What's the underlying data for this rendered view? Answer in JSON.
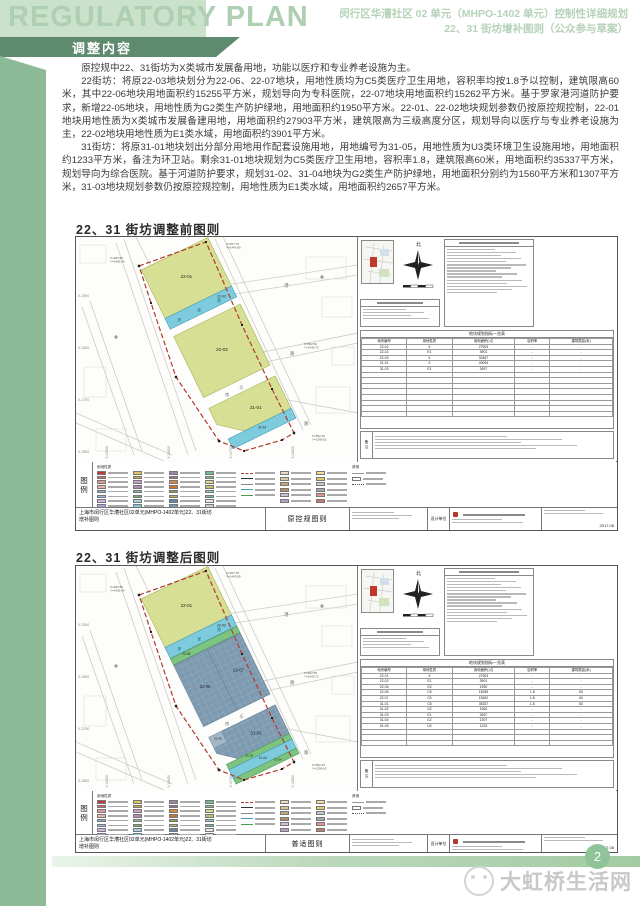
{
  "header": {
    "title": "REGULATORY PLAN",
    "banner": "调整内容",
    "line1": "闵行区华漕社区 02 单元（MHPO-1402 单元）控制性详细规划",
    "line2": "22、31 街坊增补图则（公众参与草案）"
  },
  "body": {
    "p1": "原控规中22、31街坊为X类城市发展备用地，功能以医疗和专业养老设施为主。",
    "p2": "22街坊：将原22-03地块划分为22-06、22-07地块，用地性质均为C5类医疗卫生用地，容积率均按1.8予以控制，建筑限高60米，其中22-06地块用地面积约15255平方米，规划导向为专科医院，22-07地块用地面积约15262平方米。基于罗家港河道防护要求，新增22-05地块，用地性质为G2类生产防护绿地，用地面积约1950平方米。22-01、22-02地块规划参数仍按原控规控制，22-01地块用地性质为X类城市发展备建用地，用地面积约27903平方米，建筑限高为三级高度分区，规划导向以医疗与专业养老设施为主，22-02地块用地性质为E1类水域，用地面积约3901平方米。",
    "p3": "31街坊：将原31-01地块划出分部分用地用作配套设施用地，用地编号为31-05，用地性质为U3类环境卫生设施用地，用地面积约1233平方米，备注为环卫站。剩余31-01地块规划为C5类医疗卫生用地，容积率1.8，建筑限高60米，用地面积约35337平方米，规划导向为综合医院。基于河道防护要求，规划31-02、31-04地块为G2类生产防护绿地，用地面积分别约为1560平方米和1307平方米，31-03地块规划参数仍按原控规控制，用地性质为E1类水域，用地面积约2657平方米。"
  },
  "sections": {
    "before_title": "22、31 街坊调整前图则",
    "after_title": "22、31 街坊调整后图则"
  },
  "colors": {
    "boundary_red": "#b03a2e",
    "parcel_yellow": "#d6df93",
    "parcel_yellow_stroke": "#a9b25e",
    "water_blue": "#7ecbde",
    "water_stroke": "#3f9cb8",
    "medical_blue": "#7d9ab0",
    "medical_stroke": "#5f7e96",
    "green_g2": "#7cc47f",
    "green_g2_stroke": "#4a9a50",
    "u3_fill": "#a3b7c6",
    "u3_stroke": "#7f96a8",
    "map_line": "#cccbc5",
    "map_rect": "#dddcd6"
  },
  "map_common": {
    "grid_labels_left": [
      "X-2500",
      "X-2600",
      "X-2700",
      "X-2800"
    ],
    "grid_labels_bottom": [
      "Y-14500",
      "Y-14600",
      "Y-14700",
      "Y-14800"
    ],
    "river_chars": [
      "罗",
      "家",
      "港"
    ],
    "road_gap_chars": [
      "南",
      "乐"
    ],
    "roadside_chars": [
      [
        "港",
        208,
        50
      ],
      [
        "路",
        214,
        118
      ],
      [
        "路",
        228,
        188
      ]
    ],
    "corner_notes": [
      {
        "l1": "X=263.56",
        "l2": "Y=1462.64",
        "x": 34,
        "y": 22
      },
      {
        "l1": "X=257.78",
        "l2": "Y=1443.89",
        "x": 150,
        "y": 8
      },
      {
        "l1": "X=502.59",
        "l2": "Y=1445.72",
        "x": 228,
        "y": 108
      },
      {
        "l1": "X=592.45",
        "l2": "Y=1396.62",
        "x": 236,
        "y": 200
      }
    ],
    "boundary": "63,29 130,5 166,88 196,152 218,196 206,203 168,214 143,204 100,140 75,66",
    "road_lines": [
      [
        40,
        6,
        112,
        218
      ],
      [
        48,
        2,
        120,
        214
      ],
      [
        6,
        70,
        58,
        218
      ],
      [
        14,
        64,
        66,
        214
      ],
      [
        139,
        2,
        227,
        193
      ],
      [
        147,
        0,
        235,
        188
      ],
      [
        150,
        48,
        282,
        28
      ],
      [
        152,
        58,
        282,
        38
      ],
      [
        172,
        118,
        282,
        96
      ],
      [
        175,
        128,
        282,
        106
      ],
      [
        0,
        176,
        96,
        218
      ],
      [
        0,
        186,
        88,
        224
      ],
      [
        196,
        160,
        282,
        176
      ],
      [
        60,
        0,
        74,
        28
      ]
    ],
    "bg_rects": [
      [
        4,
        8,
        26,
        18
      ],
      [
        230,
        20,
        40,
        22
      ],
      [
        240,
        150,
        34,
        26
      ],
      [
        8,
        130,
        22,
        30
      ],
      [
        246,
        60,
        30,
        20
      ],
      [
        20,
        192,
        30,
        22
      ],
      [
        256,
        110,
        22,
        18
      ]
    ],
    "cross_marks": [
      [
        63,
        29
      ],
      [
        130,
        5
      ],
      [
        166,
        88
      ],
      [
        218,
        196
      ],
      [
        100,
        140
      ],
      [
        143,
        204
      ],
      [
        246,
        40
      ],
      [
        40,
        100
      ]
    ]
  },
  "maps": {
    "before": {
      "sheet_label": "原控规图则",
      "parcels": [
        {
          "id": "22-01",
          "fill": "Y",
          "shape": "rect",
          "x": 108,
          "y": 6,
          "w": 74,
          "h": 54,
          "ls": 4.5
        },
        {
          "id": "22-02",
          "fill": "W",
          "shape": "rect",
          "x": 108,
          "y": 60,
          "w": 74,
          "h": 12,
          "ls": 3.4,
          "lx": 168,
          "ly": 66
        },
        {
          "id": "22-03",
          "fill": "Y",
          "shape": "rect",
          "x": 108,
          "y": 80,
          "w": 74,
          "h": 68,
          "ls": 4.5
        },
        {
          "id": "31-01",
          "fill": "Y",
          "shape": "poly",
          "pts": "108,160 182,160 182,196 130,196 108,178",
          "lx": 150,
          "ly": 181,
          "ls": 4.5
        },
        {
          "id": "31-03",
          "fill": "W",
          "shape": "rect",
          "x": 112,
          "y": 196,
          "w": 70,
          "h": 11,
          "ls": 3.2
        }
      ],
      "table_rows": [
        [
          "22-01",
          "X",
          "27903",
          "-",
          "-"
        ],
        [
          "22-02",
          "E1",
          "3901",
          "-",
          "-"
        ],
        [
          "22-03",
          "X",
          "32467",
          "-",
          "-"
        ],
        [
          "31-01",
          "X",
          "40094",
          "-",
          "-"
        ],
        [
          "31-03",
          "E1",
          "2657",
          "-",
          "-"
        ]
      ]
    },
    "after": {
      "sheet_label": "普适图则",
      "parcels": [
        {
          "id": "22-01",
          "fill": "Y",
          "shape": "rect",
          "x": 108,
          "y": 6,
          "w": 74,
          "h": 54,
          "ls": 4.5
        },
        {
          "id": "22-02",
          "fill": "W",
          "shape": "rect",
          "x": 108,
          "y": 60,
          "w": 74,
          "h": 12,
          "ls": 3.4,
          "lx": 168,
          "ly": 66
        },
        {
          "id": "22-05",
          "fill": "G",
          "shape": "rect",
          "x": 108,
          "y": 72.5,
          "w": 74,
          "h": 7,
          "ls": 3.2,
          "lx": 124,
          "ly": 76
        },
        {
          "id": "22-06",
          "fill": "B",
          "shape": "rect",
          "x": 108,
          "y": 80,
          "w": 37,
          "h": 68,
          "ls": 4.2
        },
        {
          "id": "22-07",
          "fill": "B",
          "shape": "rect",
          "x": 145,
          "y": 80,
          "w": 37,
          "h": 68,
          "ls": 4.2
        },
        {
          "id": "31-01",
          "fill": "B",
          "shape": "poly",
          "pts": "108,160 182,160 182,192 130,196 108,178",
          "lx": 152,
          "ly": 178,
          "ls": 4.5
        },
        {
          "id": "31-05",
          "fill": "U",
          "shape": "rect",
          "x": 108,
          "y": 160,
          "w": 14,
          "h": 12,
          "ls": 3.0
        },
        {
          "id": "31-02",
          "fill": "G",
          "shape": "rect",
          "x": 112,
          "y": 192,
          "w": 70,
          "h": 6,
          "ls": 3.0,
          "lx": 136,
          "ly": 195
        },
        {
          "id": "31-03",
          "fill": "W",
          "shape": "rect",
          "x": 112,
          "y": 198,
          "w": 70,
          "h": 10,
          "ls": 3.2
        },
        {
          "id": "31-04",
          "fill": "G",
          "shape": "rect",
          "x": 112,
          "y": 208,
          "w": 70,
          "h": 6,
          "ls": 3.0,
          "lx": 160,
          "ly": 211
        }
      ],
      "table_rows": [
        [
          "22-01",
          "X",
          "27903",
          "-",
          "-"
        ],
        [
          "22-02",
          "E1",
          "3901",
          "-",
          "-"
        ],
        [
          "22-05",
          "G2",
          "1950",
          "-",
          "-"
        ],
        [
          "22-06",
          "C5",
          "15255",
          "1.8",
          "60"
        ],
        [
          "22-07",
          "C5",
          "15262",
          "1.8",
          "60"
        ],
        [
          "31-01",
          "C5",
          "35337",
          "1.8",
          "60"
        ],
        [
          "31-02",
          "G2",
          "1560",
          "-",
          "-"
        ],
        [
          "31-03",
          "E1",
          "2657",
          "-",
          "-"
        ],
        [
          "31-04",
          "G2",
          "1307",
          "-",
          "-"
        ],
        [
          "31-05",
          "U3",
          "1233",
          "-",
          "-"
        ]
      ]
    }
  },
  "panel": {
    "table_title": "地块规划指标一览表",
    "table_headers": [
      "地块编号",
      "用地性质",
      "用地面积(㎡)",
      "容积率",
      "建筑限高(米)"
    ],
    "notes_label": "备注"
  },
  "legend": {
    "label_chars": [
      "图",
      "例"
    ],
    "col1_header": "用地性质",
    "other_header": "其他",
    "swatch_columns": [
      [
        "#c23b31",
        "#d9695f",
        "#e09a93",
        "#e8b4ad",
        "#7fb2d9",
        "#92c5e8",
        "#c9b8d8",
        "#b39ddb",
        "#f2c84b",
        "#e8d56f"
      ],
      [
        "#e5c063",
        "#d4a84b",
        "#caa0c8",
        "#b789b5",
        "#8fbf8f",
        "#6faf6f",
        "#9fd4e8",
        "#7ecbde",
        "#c9c9c9",
        "#ad9a85"
      ],
      [
        "#9a85ad",
        "#857399",
        "#d98a3f",
        "#c9762f",
        "#8a9e52",
        "#a8b868",
        "#5f8aa8",
        "#7d9ab0",
        "#b8cfe0",
        "#98b8d0"
      ],
      [
        "#6fbf8f",
        "#7cc47f",
        "#d9d98a",
        "#c2c26f",
        "#8fd0c2",
        "#6fb8a8",
        "#e8e8e8",
        "#d0d0d0",
        "#f2e8c2",
        "#e0d0a0"
      ]
    ],
    "extra_columns": [
      [
        "#e8dcc2",
        "#d9c9a0",
        "#c2a878",
        "#b09060",
        "#d0c0d8",
        "#b8a0c8"
      ],
      [
        "#f2e0a0",
        "#e8c870",
        "#c8c8c8",
        "#a8a8a8",
        "#e09890",
        "#c87868"
      ]
    ],
    "line_styles": [
      "#b03a2e",
      "#333333",
      "#888888",
      "#3f9cb8",
      "#4a9a50"
    ]
  },
  "titlebar": {
    "project_line1": "上海市闵行区华漕社区02单元(MHPO-1402单元)22、31街坊",
    "project_line2": "增补图则",
    "design_label": "设计单位",
    "date": "2017.08"
  },
  "footer": {
    "page_number": "2",
    "watermark": "大虹桥生活网"
  }
}
